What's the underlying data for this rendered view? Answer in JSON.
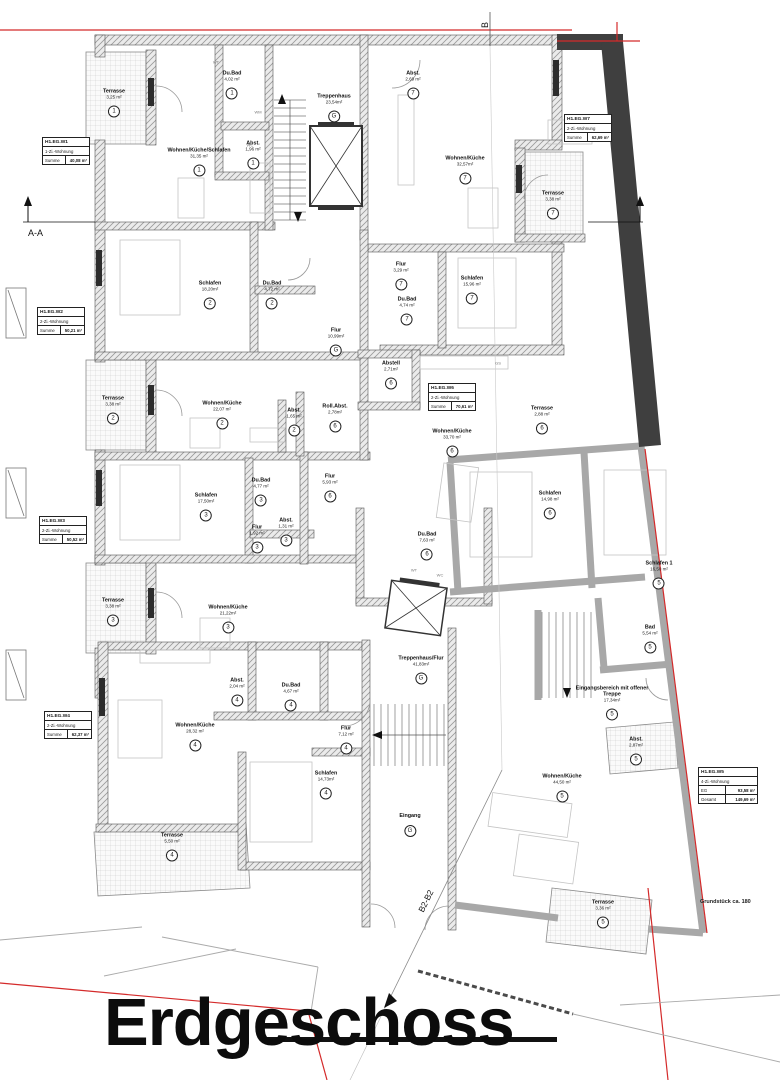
{
  "title": "Erdgeschoss",
  "site_note": "Grundstück ca. 180",
  "markers": {
    "aa": "A-A",
    "b": "B",
    "b2": "B2-B2"
  },
  "apartments": [
    {
      "name": "H1.EG.W1",
      "type": "1-Zi.-Wohnung",
      "rows": [
        {
          "k": "Summe",
          "v": "40,08 m²"
        }
      ]
    },
    {
      "name": "H1.EG.W2",
      "type": "2-Zi.-Wohnung",
      "rows": [
        {
          "k": "Summe",
          "v": "50,21 m²"
        }
      ]
    },
    {
      "name": "H1.EG.W3",
      "type": "2-Zi.-Wohnung",
      "rows": [
        {
          "k": "Summe",
          "v": "50,52 m²"
        }
      ]
    },
    {
      "name": "H1.EG.W4",
      "type": "2-Zi.-Wohnung",
      "rows": [
        {
          "k": "Summe",
          "v": "62,37 m²"
        }
      ]
    },
    {
      "name": "H1.EG.W5",
      "type": "4-Zi.-Wohnung",
      "rows": [
        {
          "k": "EG",
          "v": "93,58 m²"
        },
        {
          "k": "Gesamt",
          "v": "149,69 m²"
        }
      ]
    },
    {
      "name": "H1.EG.W6",
      "type": "2-Zi.-Wohnung",
      "rows": [
        {
          "k": "Summe",
          "v": "70,61 m²"
        }
      ]
    },
    {
      "name": "H1.EG.W7",
      "type": "2-Zi.-Wohnung",
      "rows": [
        {
          "k": "Summe",
          "v": "62,69 m²"
        }
      ]
    }
  ],
  "rooms": [
    {
      "name": "Terrasse",
      "area": "3,25 m²",
      "unit": "1"
    },
    {
      "name": "Du.Bad",
      "area": "4,02 m²",
      "unit": "1"
    },
    {
      "name": "Abst.",
      "area": "1,96 m²",
      "unit": "1"
    },
    {
      "name": "Wohnen/Küche/Schlafen",
      "area": "31,35 m²",
      "unit": "1"
    },
    {
      "name": "Treppenhaus",
      "area": "23,54m²",
      "unit": "G"
    },
    {
      "name": "Abst.",
      "area": "2,69 m²",
      "unit": "7"
    },
    {
      "name": "Wohnen/Küche",
      "area": "32,57m²",
      "unit": "7"
    },
    {
      "name": "Terrasse",
      "area": "3,38 m²",
      "unit": "7"
    },
    {
      "name": "Schlafen",
      "area": "18,20m²",
      "unit": "2"
    },
    {
      "name": "Du.Bad",
      "area": "4,72 m²",
      "unit": "2"
    },
    {
      "name": "Flur",
      "area": "3,29 m²",
      "unit": "7"
    },
    {
      "name": "Du.Bad",
      "area": "4,74 m²",
      "unit": "7"
    },
    {
      "name": "Schlafen",
      "area": "15,96 m²",
      "unit": "7"
    },
    {
      "name": "Flur",
      "area": "10,99m²",
      "unit": "G"
    },
    {
      "name": "Abstell",
      "area": "2,71m²",
      "unit": "6"
    },
    {
      "name": "Roll.Abst.",
      "area": "2,78m²",
      "unit": "6"
    },
    {
      "name": "Terrasse",
      "area": "3,38 m²",
      "unit": "2"
    },
    {
      "name": "Wohnen/Küche",
      "area": "22,07 m²",
      "unit": "2"
    },
    {
      "name": "Abst.",
      "area": "1,65 m²",
      "unit": "2"
    },
    {
      "name": "Wohnen/Küche",
      "area": "33,70 m²",
      "unit": "6"
    },
    {
      "name": "Terrasse",
      "area": "2,88 m²",
      "unit": "6"
    },
    {
      "name": "Schlafen",
      "area": "17,50m²",
      "unit": "3"
    },
    {
      "name": "Du.Bad",
      "area": "4,77 m²",
      "unit": "3"
    },
    {
      "name": "Flur",
      "area": "1,92 m²",
      "unit": "3"
    },
    {
      "name": "Abst.",
      "area": "1,31 m²",
      "unit": "3"
    },
    {
      "name": "Flur",
      "area": "5,93 m²",
      "unit": "6"
    },
    {
      "name": "Schlafen",
      "area": "14,98 m²",
      "unit": "6"
    },
    {
      "name": "Schlafen 1",
      "area": "16,50 m²",
      "unit": "5"
    },
    {
      "name": "Terrasse",
      "area": "3,38 m²",
      "unit": "3"
    },
    {
      "name": "Wohnen/Küche",
      "area": "21,22m²",
      "unit": "3"
    },
    {
      "name": "Du.Bad",
      "area": "7,63 m²",
      "unit": "6"
    },
    {
      "name": "Bad",
      "area": "5,54 m²",
      "unit": "5"
    },
    {
      "name": "Treppenhaus/Flur",
      "area": "41,83m²",
      "unit": "G"
    },
    {
      "name": "Abst.",
      "area": "2,04 m²",
      "unit": "4"
    },
    {
      "name": "Du.Bad",
      "area": "4,67 m²",
      "unit": "4"
    },
    {
      "name": "Wohnen/Küche",
      "area": "28,32 m²",
      "unit": "4"
    },
    {
      "name": "Eingangsbereich mit offener Treppe",
      "area": "17,34m²",
      "unit": "5"
    },
    {
      "name": "Abst.",
      "area": "2,87m²",
      "unit": "5"
    },
    {
      "name": "Flur",
      "area": "7,12 m²",
      "unit": "4"
    },
    {
      "name": "Schlafen",
      "area": "14,73m²",
      "unit": "4"
    },
    {
      "name": "Wohnen/Küche",
      "area": "44,50 m²",
      "unit": "5"
    },
    {
      "name": "Eingang",
      "area": "",
      "unit": "G"
    },
    {
      "name": "Terrasse",
      "area": "5,50 m²",
      "unit": "4"
    },
    {
      "name": "Terrasse",
      "area": "3,36 m²",
      "unit": "5"
    }
  ],
  "small_labels": [
    "WT",
    "WC",
    "WM",
    "GS",
    "WT",
    "WC"
  ]
}
